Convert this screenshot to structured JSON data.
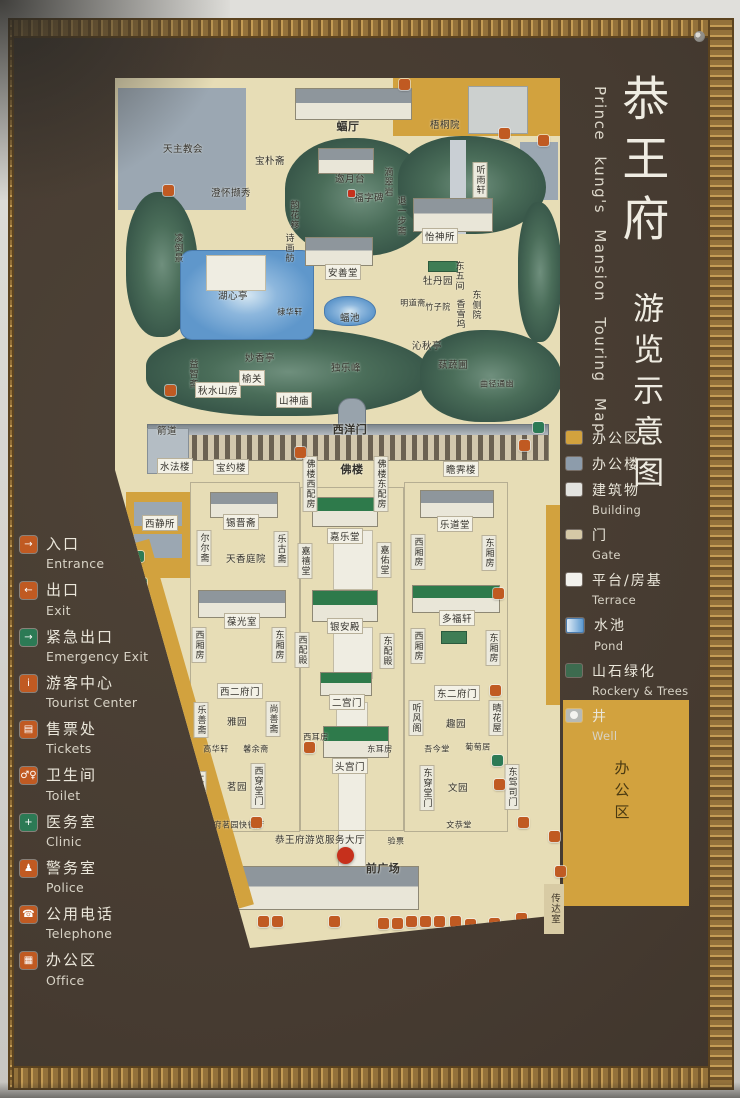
{
  "theme": {
    "orange": "#c05a22",
    "green": "#2c7a55",
    "red": "#c6301c",
    "yellow": "#d2a23e",
    "map_beige": "#e7ddb6",
    "sign_brown": "#463b31",
    "frame_gold": "#b08d52"
  },
  "title": {
    "zh_main": "恭王府",
    "zh_sub": "游览示意图",
    "en": "Prince kung's Mansion Touring Map"
  },
  "legend_left": {
    "items": [
      {
        "zh": "入口",
        "en": "Entrance",
        "glyph": "→",
        "color": "#c05a22"
      },
      {
        "zh": "出口",
        "en": "Exit",
        "glyph": "←",
        "color": "#c05a22"
      },
      {
        "zh": "紧急出口",
        "en": "Emergency Exit",
        "glyph": "→",
        "color": "#2c7a55"
      },
      {
        "zh": "游客中心",
        "en": "Tourist Center",
        "glyph": "i",
        "color": "#c05a22"
      },
      {
        "zh": "售票处",
        "en": "Tickets",
        "glyph": "▤",
        "color": "#c05a22"
      },
      {
        "zh": "卫生间",
        "en": "Toilet",
        "glyph": "♂♀",
        "color": "#c05a22"
      },
      {
        "zh": "医务室",
        "en": "Clinic",
        "glyph": "+",
        "color": "#2c7a55"
      },
      {
        "zh": "警务室",
        "en": "Police",
        "glyph": "♟",
        "color": "#c05a22"
      },
      {
        "zh": "公用电话",
        "en": "Telephone",
        "glyph": "☎",
        "color": "#c05a22"
      },
      {
        "zh": "办公区",
        "en": "Office",
        "glyph": "▦",
        "color": "#c05a22"
      }
    ]
  },
  "legend_right": {
    "items": [
      {
        "zh": "办公区",
        "en": "",
        "swatch": "#d2a23e"
      },
      {
        "zh": "办公楼",
        "en": "",
        "swatch": "#8d9cab"
      },
      {
        "zh": "建筑物",
        "en": "Building",
        "swatch": "#e3e3df"
      },
      {
        "zh": "门",
        "en": "Gate",
        "swatch": "#d5c8a6"
      },
      {
        "zh": "平台/房基",
        "en": "Terrace",
        "swatch": "#f2f1ec"
      },
      {
        "zh": "水池",
        "en": "Pond",
        "swatch": "#5d9ad0"
      },
      {
        "zh": "山石绿化",
        "en": "Rockery & Trees",
        "swatch": "#3d6b4f"
      },
      {
        "zh": "井",
        "en": "Well",
        "swatch": "#b7bab7"
      }
    ]
  },
  "map": {
    "labels": [
      {
        "t": "天主教会"
      },
      {
        "t": "宝朴斋"
      },
      {
        "t": "澄怀撷秀"
      },
      {
        "t": "凌倒景"
      },
      {
        "t": "湖心亭"
      },
      {
        "t": "韵花簃"
      },
      {
        "t": "诗画舫"
      },
      {
        "t": "蝠厅"
      },
      {
        "t": "梧桐院"
      },
      {
        "t": "邀月台"
      },
      {
        "t": "滴翠岩"
      },
      {
        "t": "福字碑"
      },
      {
        "t": "退一步斋"
      },
      {
        "t": "怡神所"
      },
      {
        "t": "听雨轩"
      },
      {
        "t": "安善堂"
      },
      {
        "t": "牡丹园"
      },
      {
        "t": "东五间"
      },
      {
        "t": "明道斋"
      },
      {
        "t": "竹子院"
      },
      {
        "t": "香雪坞"
      },
      {
        "t": "东侧院"
      },
      {
        "t": "蝠池"
      },
      {
        "t": "棣华轩"
      },
      {
        "t": "沁秋亭"
      },
      {
        "t": "独乐峰"
      },
      {
        "t": "蓺蔬圃"
      },
      {
        "t": "曲径通幽"
      },
      {
        "t": "妙香亭"
      },
      {
        "t": "益智斋"
      },
      {
        "t": "秋水山房"
      },
      {
        "t": "榆关"
      },
      {
        "t": "山神庙"
      },
      {
        "t": "箭道"
      },
      {
        "t": "西洋门"
      },
      {
        "t": "水法楼"
      },
      {
        "t": "宝约楼"
      },
      {
        "t": "佛楼"
      },
      {
        "t": "佛楼西配房"
      },
      {
        "t": "佛楼东配房"
      },
      {
        "t": "瞻霁楼"
      },
      {
        "t": "西静所"
      },
      {
        "t": "锡晋斋"
      },
      {
        "t": "尔尔斋"
      },
      {
        "t": "乐古斋"
      },
      {
        "t": "天香庭院"
      },
      {
        "t": "嘉乐堂"
      },
      {
        "t": "嘉禧堂"
      },
      {
        "t": "嘉佑堂"
      },
      {
        "t": "乐道堂"
      },
      {
        "t": "西厢房"
      },
      {
        "t": "东厢房"
      },
      {
        "t": "葆光室"
      },
      {
        "t": "西厢房"
      },
      {
        "t": "东厢房"
      },
      {
        "t": "银安殿"
      },
      {
        "t": "西配殿"
      },
      {
        "t": "东配殿"
      },
      {
        "t": "多福轩"
      },
      {
        "t": "西厢房"
      },
      {
        "t": "东厢房"
      },
      {
        "t": "西二府门"
      },
      {
        "t": "二宫门"
      },
      {
        "t": "东二府门"
      },
      {
        "t": "乐善斋"
      },
      {
        "t": "雅园"
      },
      {
        "t": "尚善斋"
      },
      {
        "t": "听风阁"
      },
      {
        "t": "趣园"
      },
      {
        "t": "晴花屋"
      },
      {
        "t": "高华轩"
      },
      {
        "t": "馨余斋"
      },
      {
        "t": "西耳房"
      },
      {
        "t": "东耳房"
      },
      {
        "t": "头宫门"
      },
      {
        "t": "仁和堂"
      },
      {
        "t": "茗园"
      },
      {
        "t": "西穿堂门"
      },
      {
        "t": "吾今堂"
      },
      {
        "t": "葡萄居"
      },
      {
        "t": "东穿堂门"
      },
      {
        "t": "文园"
      },
      {
        "t": "东驾司门"
      },
      {
        "t": "文恭堂"
      },
      {
        "t": "恭王府游览服务大厅"
      },
      {
        "t": "验票"
      },
      {
        "t": "前广场"
      },
      {
        "t": "传达室"
      },
      {
        "t": "办公区"
      },
      {
        "t": "待月轩王府茗园快餐厅"
      }
    ]
  }
}
